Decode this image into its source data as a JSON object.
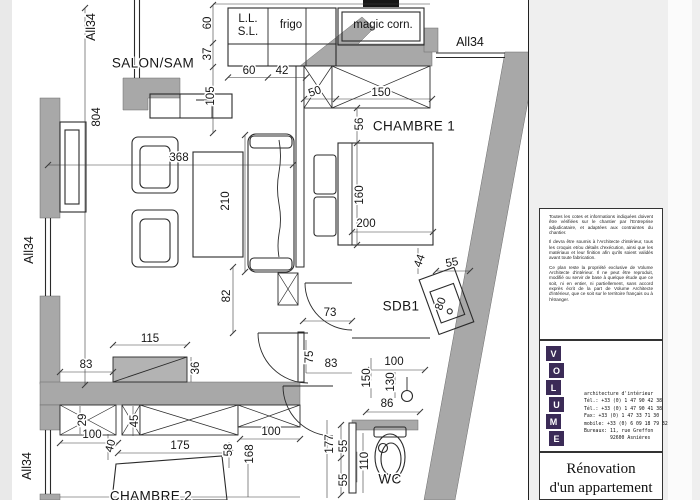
{
  "colors": {
    "wall_gray": "#a8a8a8",
    "paper": "#ffffff",
    "margin": "#e9e9e9",
    "logo_purple": "#3b2b57"
  },
  "plan": {
    "room_labels": [
      {
        "t": "SALON/SAM",
        "x": 153,
        "y": 63
      },
      {
        "t": "CHAMBRE 1",
        "x": 414,
        "y": 126
      },
      {
        "t": "SDB1",
        "x": 401,
        "y": 306
      },
      {
        "t": "WC",
        "x": 390,
        "y": 479
      },
      {
        "t": "CHAMBRE 2",
        "x": 151,
        "y": 496
      }
    ],
    "fixture_labels": [
      {
        "t": "L.L.",
        "x": 248,
        "y": 19
      },
      {
        "t": "S.L.",
        "x": 248,
        "y": 32
      },
      {
        "t": "frigo",
        "x": 291,
        "y": 25
      },
      {
        "t": "magic corn.",
        "x": 383,
        "y": 25
      }
    ],
    "window_labels": [
      {
        "t": "All34",
        "x": 91,
        "y": 27,
        "r": -90
      },
      {
        "t": "All34",
        "x": 29,
        "y": 250,
        "r": -90
      },
      {
        "t": "All34",
        "x": 27,
        "y": 466,
        "r": -90
      },
      {
        "t": "All34",
        "x": 470,
        "y": 42
      }
    ],
    "dimensions": [
      {
        "t": "804",
        "x": 97,
        "y": 117,
        "r": -90
      },
      {
        "t": "368",
        "x": 179,
        "y": 158
      },
      {
        "t": "210",
        "x": 226,
        "y": 201,
        "r": -90
      },
      {
        "t": "82",
        "x": 227,
        "y": 296,
        "r": -90
      },
      {
        "t": "115",
        "x": 150,
        "y": 339
      },
      {
        "t": "83",
        "x": 86,
        "y": 365
      },
      {
        "t": "36",
        "x": 196,
        "y": 368,
        "r": -90
      },
      {
        "t": "60",
        "x": 208,
        "y": 23,
        "r": -90
      },
      {
        "t": "37",
        "x": 208,
        "y": 54,
        "r": -90
      },
      {
        "t": "105",
        "x": 211,
        "y": 96,
        "r": -90
      },
      {
        "t": "60",
        "x": 249,
        "y": 71
      },
      {
        "t": "42",
        "x": 282,
        "y": 71
      },
      {
        "t": "50",
        "x": 315,
        "y": 92,
        "r": -20
      },
      {
        "t": "150",
        "x": 381,
        "y": 93
      },
      {
        "t": "56",
        "x": 360,
        "y": 124,
        "r": -90
      },
      {
        "t": "160",
        "x": 360,
        "y": 195,
        "r": -90
      },
      {
        "t": "200",
        "x": 366,
        "y": 224
      },
      {
        "t": "44",
        "x": 420,
        "y": 261,
        "r": -70
      },
      {
        "t": "55",
        "x": 452,
        "y": 263,
        "r": -10
      },
      {
        "t": "80",
        "x": 441,
        "y": 304,
        "r": -70
      },
      {
        "t": "73",
        "x": 330,
        "y": 313
      },
      {
        "t": "75",
        "x": 310,
        "y": 357,
        "r": -90
      },
      {
        "t": "83",
        "x": 331,
        "y": 364
      },
      {
        "t": "100",
        "x": 394,
        "y": 362
      },
      {
        "t": "150",
        "x": 367,
        "y": 378,
        "r": -90
      },
      {
        "t": "130",
        "x": 391,
        "y": 382,
        "r": -90
      },
      {
        "t": "86",
        "x": 387,
        "y": 404
      },
      {
        "t": "29",
        "x": 83,
        "y": 420,
        "r": -90
      },
      {
        "t": "45",
        "x": 135,
        "y": 421,
        "r": -90
      },
      {
        "t": "100",
        "x": 92,
        "y": 435
      },
      {
        "t": "40",
        "x": 111,
        "y": 446,
        "r": -75
      },
      {
        "t": "175",
        "x": 180,
        "y": 446
      },
      {
        "t": "58",
        "x": 229,
        "y": 450,
        "r": -90
      },
      {
        "t": "168",
        "x": 250,
        "y": 454,
        "r": -90
      },
      {
        "t": "100",
        "x": 271,
        "y": 432
      },
      {
        "t": "177",
        "x": 330,
        "y": 444,
        "r": -90
      },
      {
        "t": "55",
        "x": 344,
        "y": 446,
        "r": -90
      },
      {
        "t": "55",
        "x": 344,
        "y": 480,
        "r": -90
      },
      {
        "t": "110",
        "x": 365,
        "y": 461,
        "r": -90
      }
    ]
  },
  "title_block": {
    "disclaimer": [
      "Toutes les cotes et informations indiquées doivent être vérifiées sur le chantier par l'Entreprise adjudicataire, et adaptées aux contraintes du chantier.",
      "Il devra être soumis à l'Architecte d'intérieur, tous les croquis et/ou détails d'exécution, ainsi que les matériaux et leur finition afin qu'ils soient validés avant toute fabrication.",
      "Ce plan reste la propriété exclusive de Volume Architecte d'intérieur. Il ne peut être reproduit, modifié ou servir de base à quelque étude que ce soit, ni en entier, ni partiellement, sans accord exprès écrit de la part de Volume Architecte d'intérieur, que ce soit sur le territoire français ou à l'étranger."
    ],
    "logo_letters": [
      "V",
      "O",
      "L",
      "U",
      "M",
      "E"
    ],
    "contact_lines": [
      "architecture d'intérieur",
      "Tél.: +33 (0) 1 47 90 42 38",
      "Tél.: +33 (0) 1 47 90 41 38",
      "Fax: +33 (0) 1 47 33 71 30",
      "mobile: +33 (0) 6 09 18 79 32",
      "Bureaux: 11, rue Greffon",
      "92600 Asnières"
    ],
    "project_title": [
      "Rénovation",
      "d'un appartement"
    ]
  }
}
